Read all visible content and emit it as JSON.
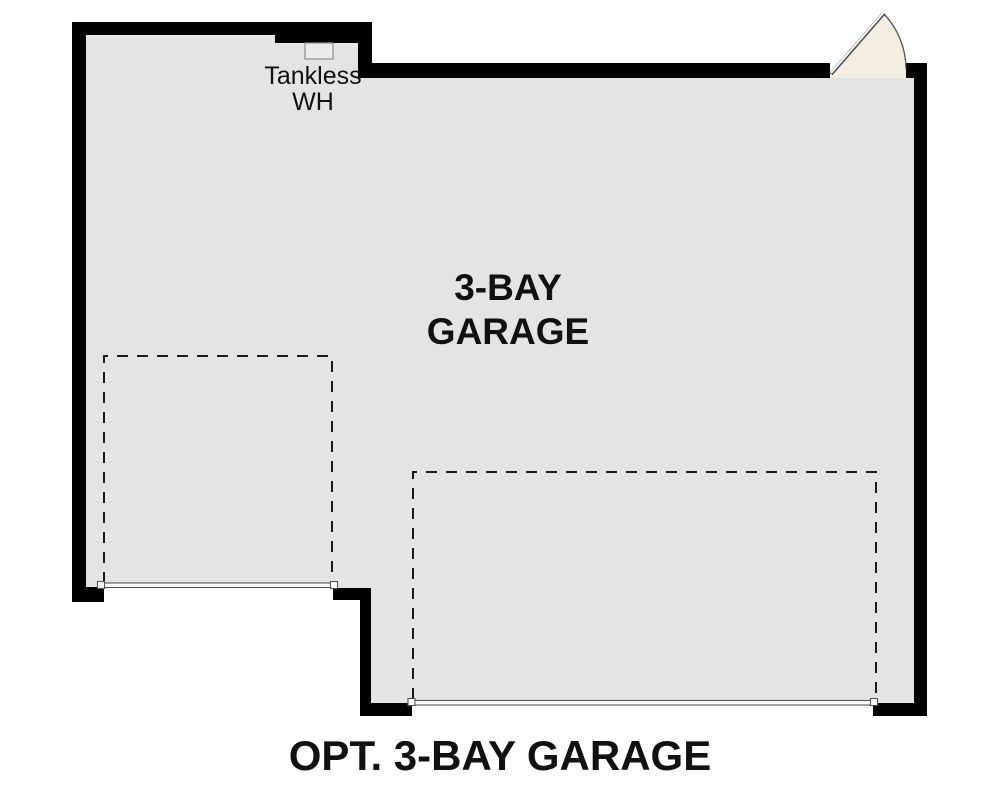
{
  "caption": {
    "text": "OPT. 3-BAY GARAGE"
  },
  "room_label": {
    "line1": "3-BAY",
    "line2": "GARAGE"
  },
  "water_heater_label": {
    "line1": "Tankless",
    "line2": "WH"
  },
  "colors": {
    "background": "#ffffff",
    "wall": "#000000",
    "floor": "#e5e4e2",
    "door_swing_fill": "#f4eee2",
    "detail_line": "#555555",
    "dashed_line": "#1a1a1a",
    "text": "#111111",
    "water_heater_fill": "#ebebe9",
    "water_heater_border": "#8f8f8f"
  }
}
